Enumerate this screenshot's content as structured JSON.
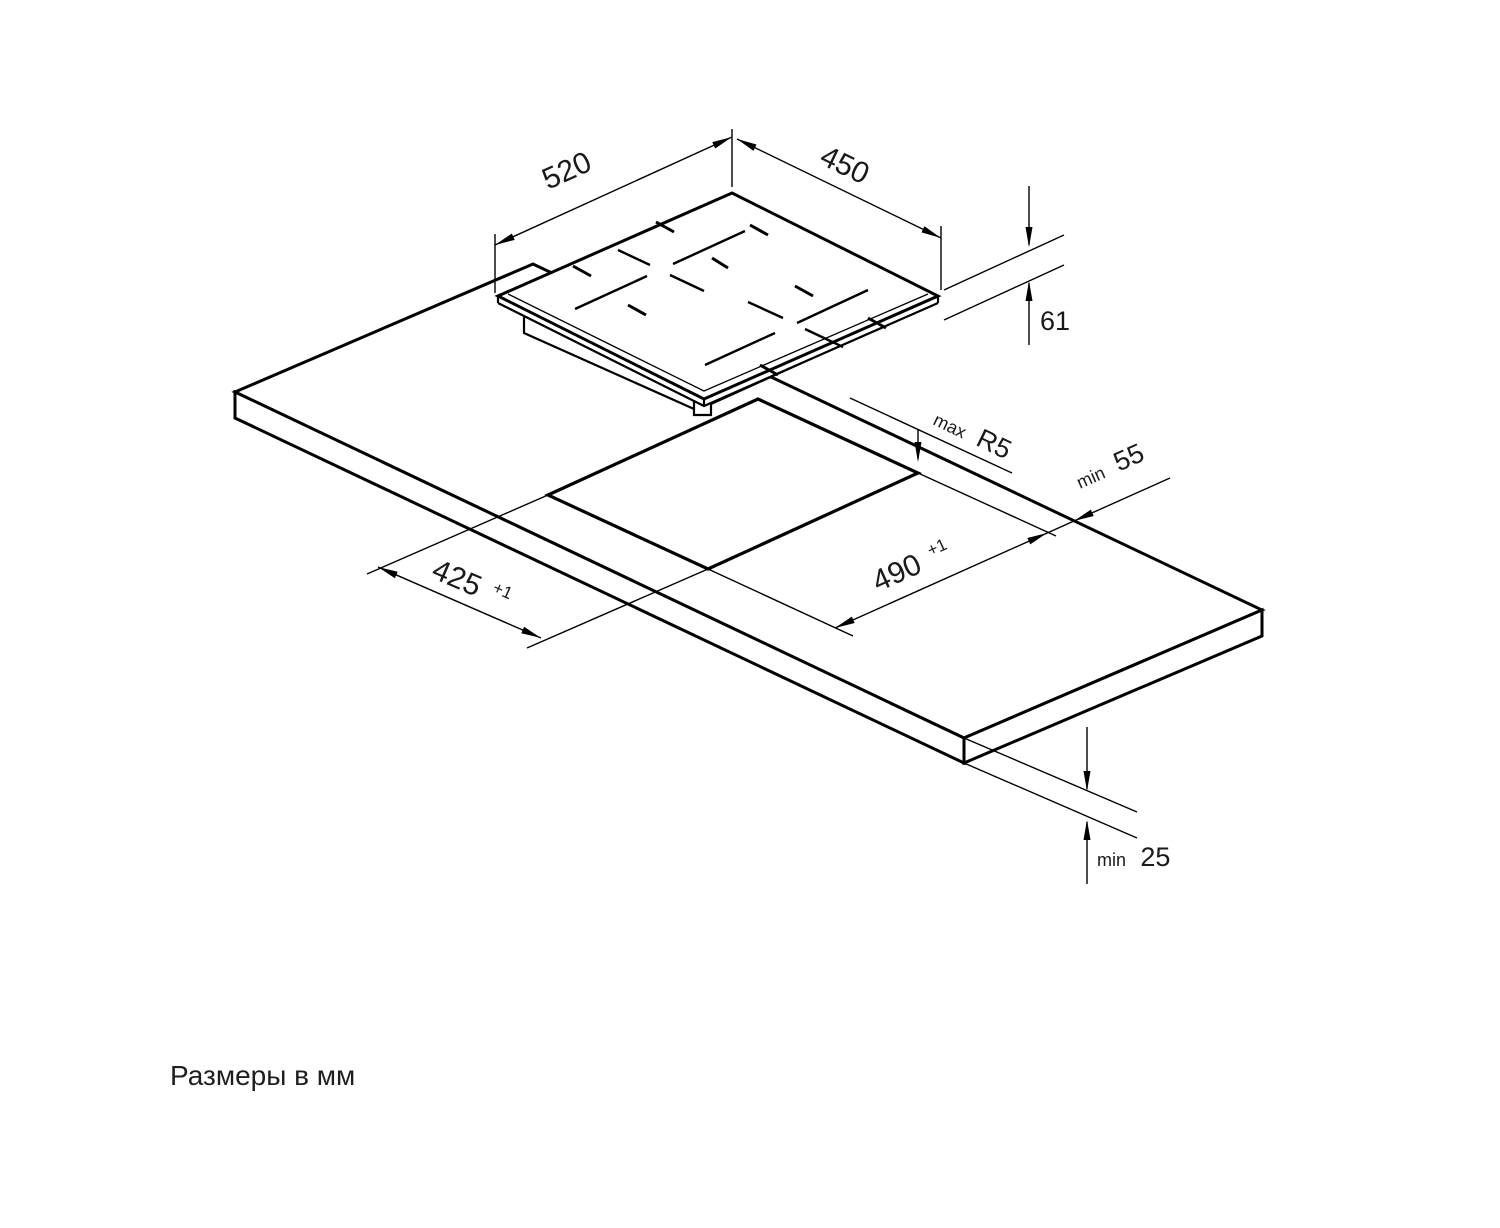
{
  "canvas": {
    "width": 1500,
    "height": 1228,
    "background": "#ffffff",
    "line_color": "#000000",
    "text_color": "#1a1a1a"
  },
  "footer": {
    "note": "Размеры в мм"
  },
  "dimensions": {
    "appliance_width": {
      "value": "520"
    },
    "appliance_depth": {
      "value": "450"
    },
    "appliance_height": {
      "value": "61"
    },
    "cutout_corner_radius": {
      "prefix": "max",
      "value": "R5"
    },
    "rear_clearance": {
      "prefix": "min",
      "value": "55"
    },
    "cutout_length": {
      "value": "490",
      "tolerance": "+1"
    },
    "cutout_width": {
      "value": "425",
      "tolerance": "+1"
    },
    "worktop_thickness": {
      "prefix": "min",
      "value": "25"
    }
  }
}
